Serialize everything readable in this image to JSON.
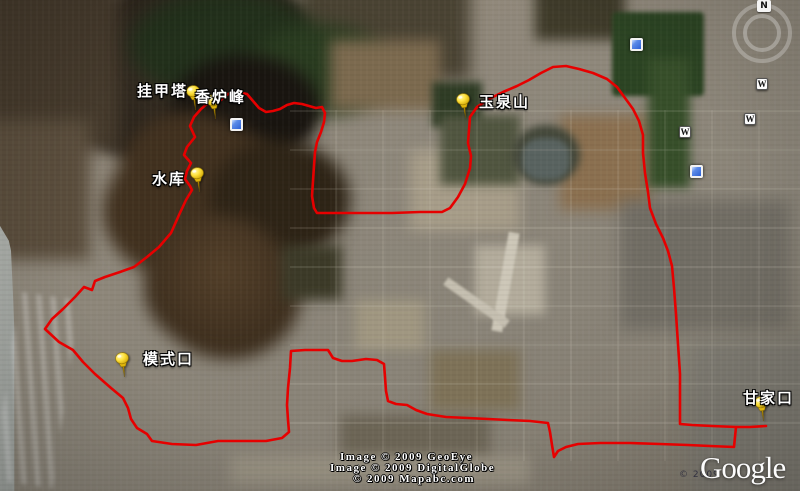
{
  "map": {
    "type": "satellite_map",
    "route_color": "#e60000",
    "label_color": "#ffffff",
    "pin_color": "#ffdf2e",
    "compass": {
      "letter": "N"
    },
    "placemarks": [
      {
        "name": "guajiata",
        "label": "挂甲塔",
        "label_x": 137,
        "label_y": 80,
        "pin_x": 196,
        "pin_y": 110
      },
      {
        "name": "xianglufeng",
        "label": "香炉峰",
        "label_x": 195,
        "label_y": 86,
        "pin_x": 216,
        "pin_y": 119
      },
      {
        "name": "shuiku",
        "label": "水库",
        "label_x": 152,
        "label_y": 168,
        "pin_x": 200,
        "pin_y": 192
      },
      {
        "name": "yuquanshan",
        "label": "玉泉山",
        "label_x": 479,
        "label_y": 91,
        "pin_x": 466,
        "pin_y": 118
      },
      {
        "name": "moshikou",
        "label": "模式口",
        "label_x": 143,
        "label_y": 348,
        "pin_x": 125,
        "pin_y": 377
      },
      {
        "name": "ganjiakou",
        "label": "甘家口",
        "label_x": 743,
        "label_y": 387,
        "pin_x": 764,
        "pin_y": 421
      }
    ],
    "photo_icons": [
      [
        237,
        125
      ],
      [
        637,
        45
      ],
      [
        697,
        172
      ]
    ],
    "wiki_icons": [
      [
        762,
        84
      ],
      [
        750,
        119
      ],
      [
        685,
        132
      ]
    ],
    "route": {
      "points": [
        [
          766,
          426
        ],
        [
          750,
          427
        ],
        [
          736,
          427
        ],
        [
          735,
          437
        ],
        [
          734,
          447
        ],
        [
          710,
          446
        ],
        [
          688,
          445
        ],
        [
          660,
          444
        ],
        [
          630,
          443
        ],
        [
          600,
          443
        ],
        [
          578,
          444
        ],
        [
          566,
          447
        ],
        [
          558,
          451
        ],
        [
          554,
          457
        ],
        [
          552,
          445
        ],
        [
          550,
          432
        ],
        [
          548,
          423
        ],
        [
          530,
          421
        ],
        [
          508,
          420
        ],
        [
          488,
          419
        ],
        [
          468,
          418
        ],
        [
          446,
          417
        ],
        [
          427,
          414
        ],
        [
          416,
          410
        ],
        [
          407,
          405
        ],
        [
          396,
          404
        ],
        [
          388,
          401
        ],
        [
          386,
          391
        ],
        [
          385,
          377
        ],
        [
          384,
          364
        ],
        [
          377,
          360
        ],
        [
          366,
          359
        ],
        [
          352,
          361
        ],
        [
          342,
          361
        ],
        [
          333,
          358
        ],
        [
          328,
          350
        ],
        [
          318,
          350
        ],
        [
          305,
          350
        ],
        [
          291,
          351
        ],
        [
          290,
          368
        ],
        [
          288,
          388
        ],
        [
          287,
          405
        ],
        [
          288,
          420
        ],
        [
          289,
          432
        ],
        [
          282,
          438
        ],
        [
          266,
          441
        ],
        [
          243,
          441
        ],
        [
          218,
          441
        ],
        [
          196,
          445
        ],
        [
          172,
          444
        ],
        [
          152,
          441
        ],
        [
          147,
          434
        ],
        [
          137,
          428
        ],
        [
          131,
          419
        ],
        [
          128,
          408
        ],
        [
          123,
          398
        ],
        [
          111,
          388
        ],
        [
          95,
          374
        ],
        [
          83,
          362
        ],
        [
          73,
          350
        ],
        [
          59,
          342
        ],
        [
          45,
          329
        ],
        [
          52,
          319
        ],
        [
          63,
          309
        ],
        [
          75,
          297
        ],
        [
          84,
          287
        ],
        [
          92,
          290
        ],
        [
          95,
          281
        ],
        [
          105,
          277
        ],
        [
          120,
          272
        ],
        [
          134,
          267
        ],
        [
          147,
          257
        ],
        [
          159,
          247
        ],
        [
          171,
          233
        ],
        [
          179,
          215
        ],
        [
          186,
          200
        ],
        [
          192,
          190
        ],
        [
          190,
          186
        ],
        [
          185,
          179
        ],
        [
          187,
          171
        ],
        [
          191,
          163
        ],
        [
          184,
          155
        ],
        [
          187,
          147
        ],
        [
          195,
          137
        ],
        [
          190,
          126
        ],
        [
          194,
          117
        ],
        [
          201,
          109
        ],
        [
          208,
          103
        ],
        [
          214,
          99
        ],
        [
          221,
          100
        ],
        [
          228,
          94
        ],
        [
          237,
          92
        ],
        [
          247,
          94
        ],
        [
          253,
          101
        ],
        [
          259,
          108
        ],
        [
          266,
          112
        ],
        [
          273,
          111
        ],
        [
          280,
          109
        ],
        [
          287,
          105
        ],
        [
          294,
          103
        ],
        [
          302,
          104
        ],
        [
          309,
          106
        ],
        [
          316,
          108
        ],
        [
          322,
          107
        ],
        [
          325,
          113
        ],
        [
          324,
          122
        ],
        [
          321,
          132
        ],
        [
          317,
          142
        ],
        [
          315,
          152
        ],
        [
          314,
          166
        ],
        [
          313,
          181
        ],
        [
          312,
          196
        ],
        [
          314,
          208
        ],
        [
          317,
          213
        ],
        [
          338,
          213
        ],
        [
          365,
          213
        ],
        [
          392,
          213
        ],
        [
          420,
          212
        ],
        [
          442,
          212
        ],
        [
          450,
          208
        ],
        [
          458,
          197
        ],
        [
          465,
          184
        ],
        [
          470,
          168
        ],
        [
          471,
          156
        ],
        [
          468,
          143
        ],
        [
          469,
          130
        ],
        [
          470,
          117
        ],
        [
          477,
          107
        ],
        [
          489,
          99
        ],
        [
          503,
          92
        ],
        [
          517,
          86
        ],
        [
          529,
          80
        ],
        [
          541,
          73
        ],
        [
          553,
          67
        ],
        [
          566,
          66
        ],
        [
          579,
          69
        ],
        [
          593,
          73
        ],
        [
          607,
          79
        ],
        [
          617,
          87
        ],
        [
          625,
          98
        ],
        [
          633,
          109
        ],
        [
          639,
          121
        ],
        [
          643,
          135
        ],
        [
          643,
          153
        ],
        [
          645,
          173
        ],
        [
          648,
          192
        ],
        [
          650,
          208
        ],
        [
          656,
          224
        ],
        [
          663,
          238
        ],
        [
          668,
          251
        ],
        [
          672,
          266
        ],
        [
          674,
          288
        ],
        [
          676,
          314
        ],
        [
          678,
          344
        ],
        [
          680,
          374
        ],
        [
          680,
          402
        ],
        [
          680,
          424
        ],
        [
          692,
          425
        ],
        [
          712,
          426
        ],
        [
          736,
          427
        ]
      ]
    },
    "attribution": [
      "Image © 2009 GeoEye",
      "Image © 2009 DigitalGlobe",
      "© 2009 Mapabc.com"
    ],
    "logo": {
      "text": "Google",
      "year": "© 2009"
    }
  }
}
